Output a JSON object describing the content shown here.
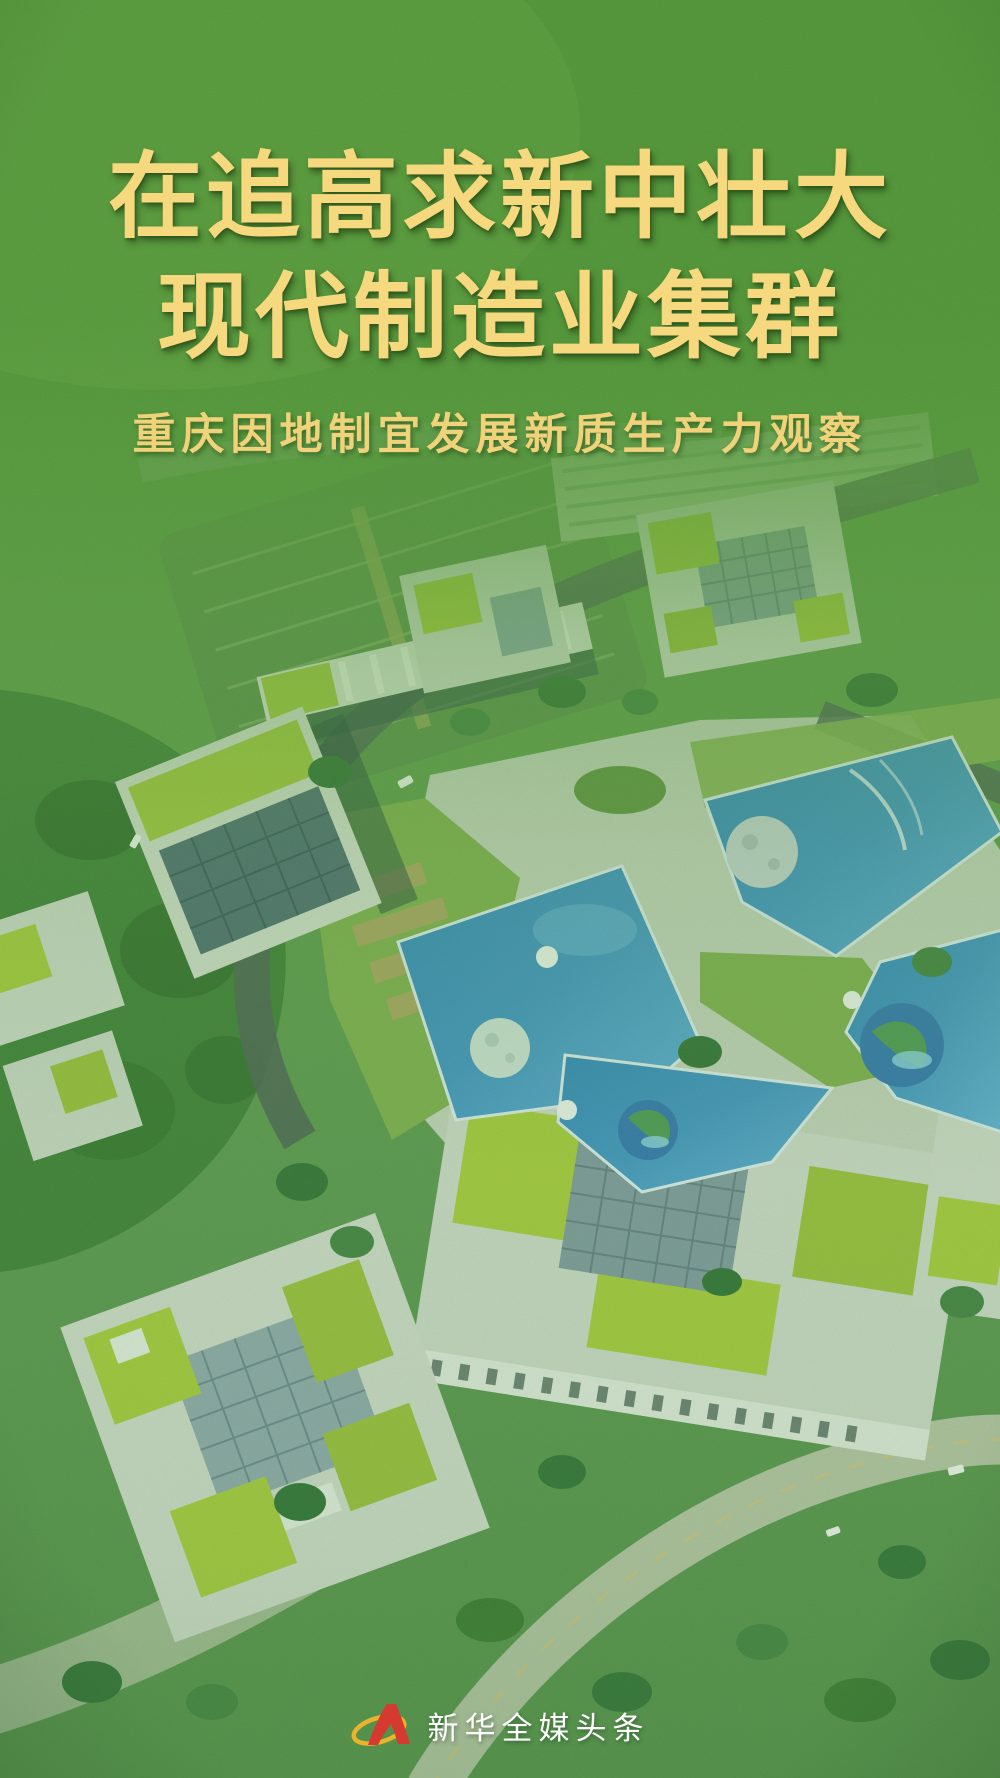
{
  "poster": {
    "title": {
      "line1": "在追高求新中壮大",
      "line2": "现代制造业集群"
    },
    "subtitle": "重庆因地制宜发展新质生产力观察",
    "brand": {
      "label": "新华全媒头条"
    },
    "colors": {
      "title_gold": "#F6D97F",
      "subtitle_gold": "#F0D27B",
      "overlay_green": "#4F9335",
      "pool_blue": "#3E93C8",
      "roof_green": "#A9CB3B",
      "building_gray": "#D2DCCF",
      "brand_red": "#D43A2F",
      "brand_gold": "#E9B32B",
      "brand_text": "#FFFFFF"
    }
  }
}
